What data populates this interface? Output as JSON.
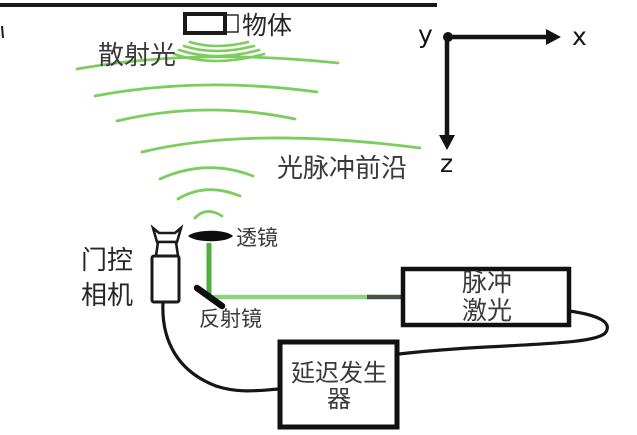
{
  "figure": {
    "title_semantic": "gated-camera scattering imaging setup diagram",
    "labels": {
      "object": "物体",
      "scattered_light": "散射光",
      "light_pulse_front": "光脉冲前沿",
      "lens": "透镜",
      "gated_camera_line1": "门控",
      "gated_camera_line2": "相机",
      "mirror": "反射镜",
      "pulsed_laser_line1": "脉冲",
      "pulsed_laser_line2": "激光",
      "delay_generator_line1": "延迟发生",
      "delay_generator_line2": "器",
      "axis_x": "x",
      "axis_y": "y",
      "axis_z": "z"
    },
    "colors": {
      "wavefront_green": "#7ccd5e",
      "beam_green_vertical": "#4fae3f",
      "beam_green_horizontal": "#90d080",
      "beam_dark_segment": "#4a4f45",
      "outline_black": "#1a1a1a",
      "label_gray": "#3a3a3a",
      "background": "#ffffff"
    }
  }
}
